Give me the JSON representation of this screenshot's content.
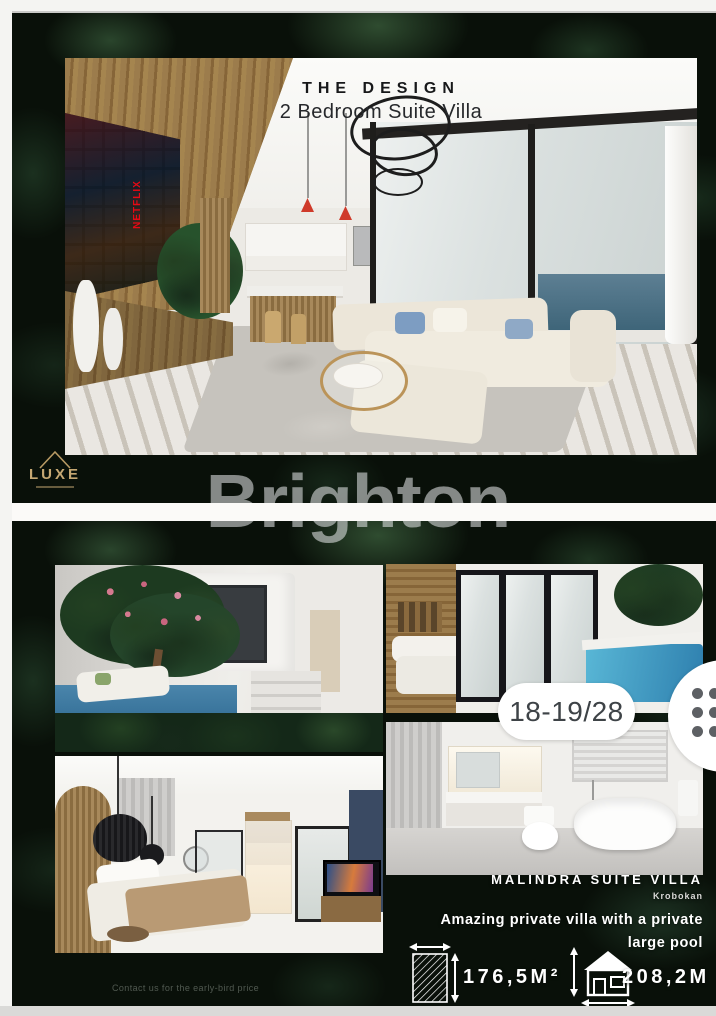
{
  "viewer": {
    "page_indicator": "18-19/28",
    "watermark": "Brighton"
  },
  "design_flyer": {
    "title": "THE DESIGN",
    "subtitle": "2 Bedroom Suite Villa",
    "tv_brand": "NETFLIX",
    "brand_logo": "LUXE"
  },
  "listing_flyer": {
    "name": "MALINDRA SUITE VILLA",
    "location": "Krobokan",
    "tagline_line1": "Amazing private villa with a private",
    "tagline_line2": "large pool",
    "land_area": "176,5M²",
    "building_size": "208,2M",
    "footer_note": "Contact us for the early-bird price"
  },
  "icons": {
    "menu_dots": "six-dot-drag-handle",
    "land_area": "land-dimensions-hatched-square",
    "building_size": "house-dimensions",
    "luxe_mark": "house-outline"
  },
  "colors": {
    "pill_bg": "#ffffff",
    "pill_text": "#3e4347",
    "pool_blue": "#3f7fa6",
    "netflix_red": "#e50914",
    "gold": "#c6a873",
    "leaf_base": "#091009",
    "frame_white": "#f4f4f2"
  }
}
